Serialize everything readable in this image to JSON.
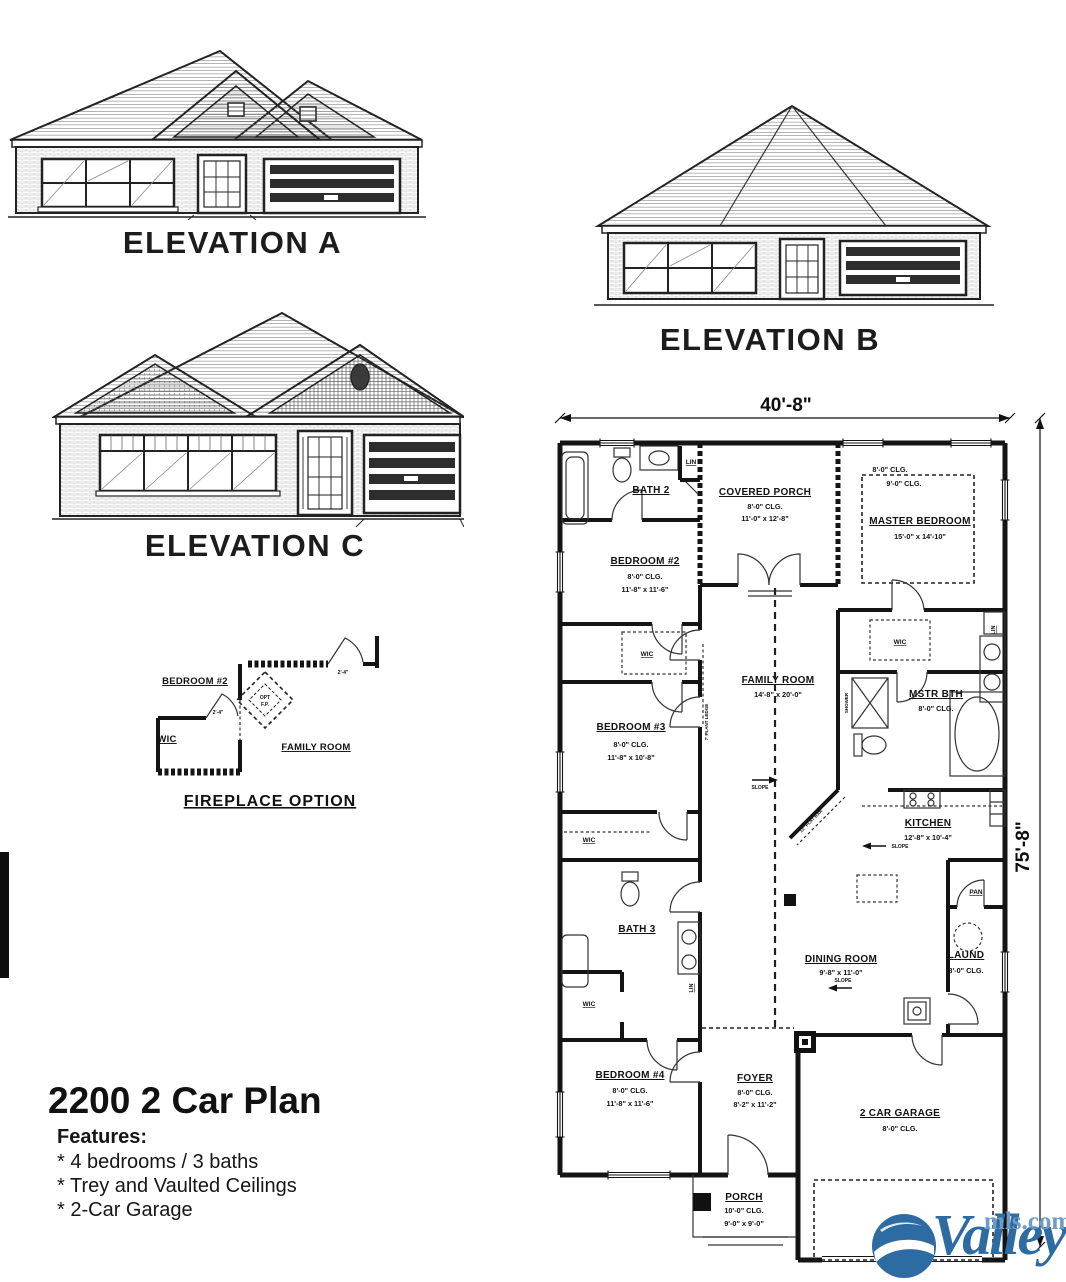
{
  "elevations": {
    "a": "ELEVATION A",
    "b": "ELEVATION B",
    "c": "ELEVATION C"
  },
  "fireplace": {
    "title": "FIREPLACE OPTION",
    "bedroom2": "BEDROOM #2",
    "wic": "WIC",
    "family_room": "FAMILY ROOM",
    "opt1": "OPT",
    "opt2": "F.P.",
    "dim": "2'-4\""
  },
  "plan": {
    "dim_width": "40'-8\"",
    "dim_height": "75'-8\"",
    "bath2": "BATH 2",
    "lin": "LIN",
    "wic": "WIC",
    "slope": "SLOPE",
    "shower": "SHOWER",
    "plant_ledge": "7' PLANT LEDGE",
    "flat_bar": "12\" FLAT BAR",
    "covered_porch": {
      "name": "COVERED PORCH",
      "clg": "8'-0\" CLG.",
      "size": "11'-0\" x 12'-8\""
    },
    "master": {
      "clg8": "8'-0\" CLG.",
      "clg9": "9'-0\" CLG.",
      "name": "MASTER BEDROOM",
      "size": "15'-0\" x 14'-10\""
    },
    "bedroom2": {
      "name": "BEDROOM #2",
      "clg": "8'-0\" CLG.",
      "size": "11'-8\" x 11'-6\""
    },
    "family": {
      "name": "FAMILY ROOM",
      "size": "14'-8\" x 20'-0\""
    },
    "mstr_bth": {
      "name": "MSTR BTH",
      "clg": "8'-0\" CLG."
    },
    "bedroom3": {
      "name": "BEDROOM #3",
      "clg": "8'-0\" CLG.",
      "size": "11'-8\" x 10'-8\""
    },
    "kitchen": {
      "name": "KITCHEN",
      "size": "12'-8\" x 10'-4\""
    },
    "bath3": "BATH 3",
    "pan": "PAN",
    "dining": {
      "name": "DINING ROOM",
      "size": "9'-8\" x 11'-0\""
    },
    "laund": {
      "name": "LAUND",
      "clg": "8'-0\" CLG."
    },
    "bedroom4": {
      "name": "BEDROOM #4",
      "clg": "8'-0\" CLG.",
      "size": "11'-8\" x 11'-6\""
    },
    "foyer": {
      "name": "FOYER",
      "clg": "8'-0\" CLG.",
      "size": "8'-2\" x 11'-2\""
    },
    "garage": {
      "name": "2 CAR GARAGE",
      "clg": "8'-0\" CLG."
    },
    "porch": {
      "name": "PORCH",
      "clg": "10'-0\" CLG.",
      "size": "9'-0\" x 9'-0\""
    }
  },
  "info": {
    "title": "2200 2 Car Plan",
    "features_heading": "Features:",
    "features": [
      "* 4 bedrooms / 3 baths",
      "* Trey and Vaulted Ceilings",
      "* 2-Car Garage"
    ]
  },
  "logo": {
    "brand": "Valley",
    "suffix": "mls.com",
    "color": "#2d6ba3"
  }
}
